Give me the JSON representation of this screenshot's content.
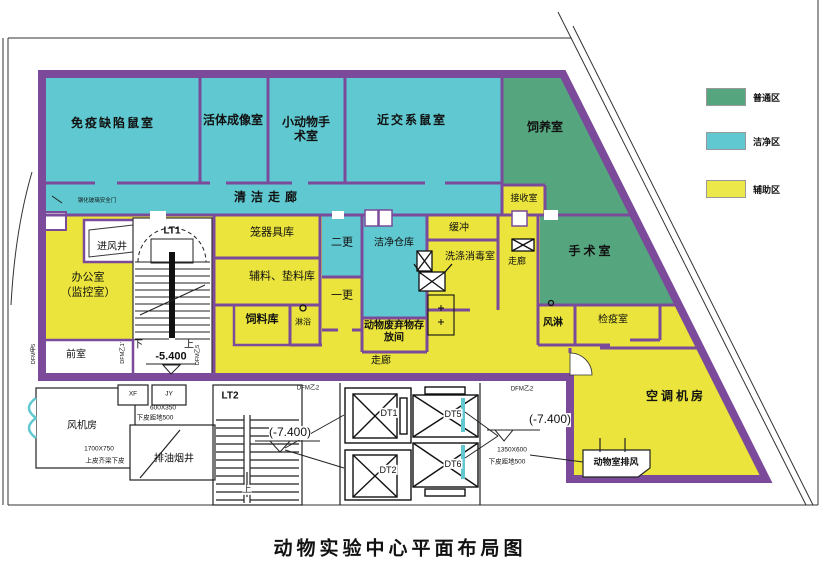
{
  "title": "动物实验中心平面布局图",
  "legend": {
    "items": [
      {
        "label": "普通区",
        "color": "#55A57F"
      },
      {
        "label": "洁净区",
        "color": "#5FC8D0"
      },
      {
        "label": "辅助区",
        "color": "#EDE84A"
      }
    ]
  },
  "wall_color": "#7B4A9B",
  "rooms": {
    "immuno": "免疫缺陷鼠室",
    "imaging": "活体成像室",
    "small_surgery": "小动物手术室",
    "inbred": "近交系鼠室",
    "breeding": "饲养室",
    "clean_corridor": "清洁走廊",
    "receiving": "接收室",
    "cage_store": "笼器具库",
    "second_change": "二更",
    "clean_warehouse": "洁净仓库",
    "buffer": "缓冲",
    "washing": "洗涤消毒室",
    "corridor_vertical": "走廊",
    "surgery": "手术室",
    "material_store": "辅料、垫料库",
    "first_change": "一更",
    "feed_store": "饲料库",
    "shower": "淋浴",
    "waste_room": "动物废弃物存放间",
    "air_shower": "风淋",
    "quarantine": "检疫室",
    "corridor_bottom": "走廊",
    "office_line1": "办公室",
    "office_line2": "（监控室）",
    "air_inlet": "进风井",
    "front_room": "前室",
    "ac_room": "空调机房",
    "animal_exhaust": "动物室排风",
    "fan_room": "风机房",
    "oil_shaft": "排油烟井"
  },
  "stairs": {
    "lt1": "LT1",
    "lt2": "LT2",
    "down": "下",
    "up": "上",
    "up2": "上"
  },
  "elevators": {
    "dt1": "DT1",
    "dt2": "DT2",
    "dt5": "DT5",
    "dt6": "DT6"
  },
  "elevations": {
    "lt1_level": "-5.400",
    "pit_left": "(-7.400)",
    "pit_right": "(-7.400)"
  },
  "codes": {
    "dfm_a5": "DFM甲5",
    "dfm_b1": "DFM乙1'",
    "dfm_b5": "DFM乙5",
    "dfm_b2_left": "DFM乙2",
    "dfm_b2_right": "DFM乙2",
    "xf": "XF",
    "jy": "JY"
  },
  "dimensions": {
    "duct1_size": "600X350",
    "duct1_note": "下皮距地500",
    "duct2_size": "1700X750",
    "duct2_note": "上皮齐梁下皮",
    "duct3_size": "1350X600",
    "duct3_note": "下皮距地500"
  },
  "notes": {
    "glass_door": "钢化玻璃安全门"
  }
}
